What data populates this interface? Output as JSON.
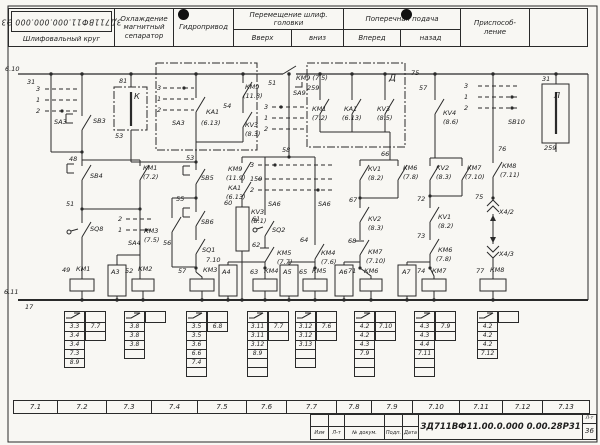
{
  "header": {
    "stamp": "ЗД711ВФ11.000.000.000 Э3",
    "cells": [
      {
        "label": "Шлифовальный круг"
      },
      {
        "label": "Охлаждение магнитный сепаратор"
      },
      {
        "label": "Гидропривод"
      },
      {
        "label": "Перемещение шлиф. головки",
        "sub": [
          "Вверх",
          "вниз"
        ]
      },
      {
        "label": "Поперечная подача",
        "sub": [
          "Вперед",
          "назад"
        ]
      },
      {
        "label": "Приспособ- ление"
      },
      {
        "label": ""
      }
    ]
  },
  "schematic": {
    "labels": [
      {
        "t": "6.10",
        "x": 5,
        "y": 69
      },
      {
        "t": "31",
        "x": 27,
        "y": 82
      },
      {
        "t": "3",
        "x": 36,
        "y": 89
      },
      {
        "t": "1",
        "x": 36,
        "y": 100
      },
      {
        "t": "2",
        "x": 36,
        "y": 111
      },
      {
        "t": "SA3",
        "x": 54,
        "y": 122
      },
      {
        "t": "SB3",
        "x": 93,
        "y": 121
      },
      {
        "t": "81",
        "x": 119,
        "y": 81
      },
      {
        "t": "К",
        "x": 134,
        "y": 97,
        "s": 8
      },
      {
        "t": "53",
        "x": 115,
        "y": 136
      },
      {
        "t": "48",
        "x": 69,
        "y": 159
      },
      {
        "t": "SB4",
        "x": 90,
        "y": 176
      },
      {
        "t": "51",
        "x": 66,
        "y": 204
      },
      {
        "t": "SQ8",
        "x": 90,
        "y": 229
      },
      {
        "t": "2",
        "x": 118,
        "y": 219
      },
      {
        "t": "1",
        "x": 118,
        "y": 230
      },
      {
        "t": "SA4",
        "x": 128,
        "y": 243
      },
      {
        "t": "КМ1",
        "x": 143,
        "y": 168
      },
      {
        "t": "(7.2)",
        "x": 143,
        "y": 177
      },
      {
        "t": "49",
        "x": 62,
        "y": 270
      },
      {
        "t": "КМ1",
        "x": 76,
        "y": 269
      },
      {
        "t": "А3",
        "x": 111,
        "y": 272
      },
      {
        "t": "52",
        "x": 125,
        "y": 271
      },
      {
        "t": "КМ2",
        "x": 138,
        "y": 269
      },
      {
        "t": "3",
        "x": 157,
        "y": 88
      },
      {
        "t": "1",
        "x": 157,
        "y": 99
      },
      {
        "t": "2",
        "x": 157,
        "y": 110
      },
      {
        "t": "SA3",
        "x": 172,
        "y": 123
      },
      {
        "t": "КА1",
        "x": 206,
        "y": 112
      },
      {
        "t": "54",
        "x": 223,
        "y": 106
      },
      {
        "t": "(6.13)",
        "x": 201,
        "y": 123
      },
      {
        "t": "КМ9",
        "x": 245,
        "y": 87
      },
      {
        "t": "(11.8)",
        "x": 243,
        "y": 96
      },
      {
        "t": "КV3",
        "x": 245,
        "y": 125
      },
      {
        "t": "(8.3)",
        "x": 245,
        "y": 134
      },
      {
        "t": "53",
        "x": 186,
        "y": 158
      },
      {
        "t": "SB5",
        "x": 201,
        "y": 178
      },
      {
        "t": "55",
        "x": 176,
        "y": 199
      },
      {
        "t": "SB6",
        "x": 201,
        "y": 222
      },
      {
        "t": "КМ3",
        "x": 144,
        "y": 231
      },
      {
        "t": "(7.5)",
        "x": 144,
        "y": 240
      },
      {
        "t": "56",
        "x": 163,
        "y": 243
      },
      {
        "t": "SQ1",
        "x": 202,
        "y": 250
      },
      {
        "t": "7.10",
        "x": 206,
        "y": 260
      },
      {
        "t": "57",
        "x": 178,
        "y": 271
      },
      {
        "t": "КМ3",
        "x": 203,
        "y": 270
      },
      {
        "t": "КМ9",
        "x": 228,
        "y": 169
      },
      {
        "t": "(11.9)",
        "x": 226,
        "y": 178
      },
      {
        "t": "50",
        "x": 254,
        "y": 179
      },
      {
        "t": "КА1",
        "x": 228,
        "y": 188
      },
      {
        "t": "(6.13)",
        "x": 226,
        "y": 197
      },
      {
        "t": "60",
        "x": 224,
        "y": 203
      },
      {
        "t": "КV3",
        "x": 251,
        "y": 212
      },
      {
        "t": "(8.1)",
        "x": 251,
        "y": 221
      },
      {
        "t": "51",
        "x": 268,
        "y": 83
      },
      {
        "t": "SA9",
        "x": 293,
        "y": 93
      },
      {
        "t": "3",
        "x": 264,
        "y": 107
      },
      {
        "t": "1",
        "x": 264,
        "y": 118
      },
      {
        "t": "2",
        "x": 264,
        "y": 129
      },
      {
        "t": "58",
        "x": 282,
        "y": 150
      },
      {
        "t": "3",
        "x": 250,
        "y": 165
      },
      {
        "t": "1",
        "x": 250,
        "y": 179
      },
      {
        "t": "2",
        "x": 250,
        "y": 190
      },
      {
        "t": "SA6",
        "x": 268,
        "y": 204
      },
      {
        "t": "SA6",
        "x": 318,
        "y": 204
      },
      {
        "t": "61",
        "x": 252,
        "y": 219
      },
      {
        "t": "SQ2",
        "x": 272,
        "y": 230
      },
      {
        "t": "62",
        "x": 252,
        "y": 245
      },
      {
        "t": "КМ5",
        "x": 277,
        "y": 253
      },
      {
        "t": "(7.7)",
        "x": 277,
        "y": 262
      },
      {
        "t": "64",
        "x": 300,
        "y": 240
      },
      {
        "t": "КМ4",
        "x": 321,
        "y": 253
      },
      {
        "t": "(7.6)",
        "x": 321,
        "y": 262
      },
      {
        "t": "63",
        "x": 250,
        "y": 272
      },
      {
        "t": "КМ4",
        "x": 264,
        "y": 271
      },
      {
        "t": "65",
        "x": 299,
        "y": 272
      },
      {
        "t": "КМ5",
        "x": 312,
        "y": 271
      },
      {
        "t": "А4",
        "x": 222,
        "y": 272
      },
      {
        "t": "А5",
        "x": 283,
        "y": 272
      },
      {
        "t": "КМ9 (7.5)",
        "x": 296,
        "y": 78
      },
      {
        "t": "259",
        "x": 307,
        "y": 88
      },
      {
        "t": "Д",
        "x": 389,
        "y": 79,
        "s": 9
      },
      {
        "t": "КМ1",
        "x": 312,
        "y": 109
      },
      {
        "t": "(7.2)",
        "x": 312,
        "y": 118
      },
      {
        "t": "КА1",
        "x": 344,
        "y": 109
      },
      {
        "t": "(6.13)",
        "x": 342,
        "y": 118
      },
      {
        "t": "КV3",
        "x": 377,
        "y": 109
      },
      {
        "t": "(8.5)",
        "x": 377,
        "y": 118
      },
      {
        "t": "75",
        "x": 411,
        "y": 73
      },
      {
        "t": "57",
        "x": 419,
        "y": 88
      },
      {
        "t": "КV4",
        "x": 443,
        "y": 113
      },
      {
        "t": "(8.6)",
        "x": 443,
        "y": 122
      },
      {
        "t": "66",
        "x": 381,
        "y": 154
      },
      {
        "t": "КV1",
        "x": 368,
        "y": 169
      },
      {
        "t": "(8.2)",
        "x": 368,
        "y": 178
      },
      {
        "t": "КМ6",
        "x": 403,
        "y": 168
      },
      {
        "t": "(7.8)",
        "x": 403,
        "y": 177
      },
      {
        "t": "67",
        "x": 349,
        "y": 200
      },
      {
        "t": "КV2",
        "x": 368,
        "y": 219
      },
      {
        "t": "(8.3)",
        "x": 368,
        "y": 228
      },
      {
        "t": "68",
        "x": 348,
        "y": 241
      },
      {
        "t": "КМ7",
        "x": 368,
        "y": 252
      },
      {
        "t": "(7.10)",
        "x": 366,
        "y": 261
      },
      {
        "t": "71",
        "x": 348,
        "y": 271
      },
      {
        "t": "КМ6",
        "x": 364,
        "y": 271
      },
      {
        "t": "А6",
        "x": 339,
        "y": 272
      },
      {
        "t": "КV2",
        "x": 436,
        "y": 168
      },
      {
        "t": "(8.3)",
        "x": 436,
        "y": 177
      },
      {
        "t": "КМ7",
        "x": 467,
        "y": 168
      },
      {
        "t": "(7.10)",
        "x": 465,
        "y": 177
      },
      {
        "t": "72",
        "x": 417,
        "y": 199
      },
      {
        "t": "КV1",
        "x": 438,
        "y": 217
      },
      {
        "t": "(8.2)",
        "x": 438,
        "y": 226
      },
      {
        "t": "73",
        "x": 417,
        "y": 236
      },
      {
        "t": "КМ6",
        "x": 438,
        "y": 250
      },
      {
        "t": "(7.8)",
        "x": 436,
        "y": 259
      },
      {
        "t": "74",
        "x": 417,
        "y": 271
      },
      {
        "t": "КМ7",
        "x": 432,
        "y": 271
      },
      {
        "t": "А7",
        "x": 402,
        "y": 272
      },
      {
        "t": "3",
        "x": 464,
        "y": 86
      },
      {
        "t": "1",
        "x": 464,
        "y": 97
      },
      {
        "t": "2",
        "x": 464,
        "y": 108
      },
      {
        "t": "SB10",
        "x": 508,
        "y": 122
      },
      {
        "t": "76",
        "x": 498,
        "y": 149
      },
      {
        "t": "КМ8",
        "x": 502,
        "y": 166
      },
      {
        "t": "(7.11)",
        "x": 500,
        "y": 175
      },
      {
        "t": "75",
        "x": 475,
        "y": 197
      },
      {
        "t": "Х4/2",
        "x": 499,
        "y": 212
      },
      {
        "t": "Х4/3",
        "x": 499,
        "y": 254
      },
      {
        "t": "77",
        "x": 476,
        "y": 271
      },
      {
        "t": "КМ8",
        "x": 490,
        "y": 270
      },
      {
        "t": "31",
        "x": 542,
        "y": 79
      },
      {
        "t": "Л",
        "x": 554,
        "y": 96,
        "s": 8
      },
      {
        "t": "259",
        "x": 544,
        "y": 148
      },
      {
        "t": "6.11",
        "x": 4,
        "y": 292
      },
      {
        "t": "17",
        "x": 25,
        "y": 307
      }
    ]
  },
  "contact_tables": [
    {
      "x": 64,
      "no": [
        "3.3",
        "3.4",
        "3.4",
        "7.3",
        "8.9"
      ],
      "nc": [
        "7.7",
        ""
      ]
    },
    {
      "x": 124,
      "no": [
        "3.8",
        "3.8",
        "3.8",
        ""
      ],
      "nc": []
    },
    {
      "x": 186,
      "no": [
        "3.5",
        "3.5",
        "3.6",
        "6.6",
        "7.4",
        ""
      ],
      "nc": [
        "6.8"
      ]
    },
    {
      "x": 247,
      "no": [
        "3.11",
        "3.11",
        "3.12",
        "8.9",
        "",
        ""
      ],
      "nc": [
        "7.7",
        ""
      ]
    },
    {
      "x": 295,
      "no": [
        "3.12",
        "3.12",
        "3.13",
        "",
        ""
      ],
      "nc": [
        "7.6",
        ""
      ]
    },
    {
      "x": 354,
      "no": [
        "4.2",
        "4.2",
        "4.3",
        "7.9",
        "",
        ""
      ],
      "nc": [
        "7.10",
        ""
      ]
    },
    {
      "x": 414,
      "no": [
        "4.3",
        "4.3",
        "4.4",
        "7.11",
        "",
        ""
      ],
      "nc": [
        "7.9",
        ""
      ]
    },
    {
      "x": 477,
      "no": [
        "4.2",
        "4.2",
        "4.2",
        "7.12"
      ],
      "nc": []
    }
  ],
  "zones": [
    {
      "label": "7.1",
      "x": 13,
      "w": 45
    },
    {
      "label": "7.2",
      "x": 57,
      "w": 50
    },
    {
      "label": "7.3",
      "x": 106,
      "w": 46
    },
    {
      "label": "7.4",
      "x": 151,
      "w": 47
    },
    {
      "label": "7.5",
      "x": 197,
      "w": 50
    },
    {
      "label": "7.6",
      "x": 246,
      "w": 41
    },
    {
      "label": "7.7",
      "x": 286,
      "w": 51
    },
    {
      "label": "7.8",
      "x": 336,
      "w": 36
    },
    {
      "label": "7.9",
      "x": 371,
      "w": 42
    },
    {
      "label": "7.10",
      "x": 412,
      "w": 48
    },
    {
      "label": "7.11",
      "x": 459,
      "w": 44
    },
    {
      "label": "7.12",
      "x": 502,
      "w": 41
    },
    {
      "label": "7.13",
      "x": 542,
      "w": 48
    }
  ],
  "titleblock": {
    "cols": [
      "Изм",
      "Л-т",
      "№ докум.",
      "Подп.",
      "Дата"
    ],
    "doc_number": "ЗД711ВФ11.00.0.000 0.00.28Р31",
    "sheet_label": "Л-т",
    "sheet_number": "36"
  }
}
